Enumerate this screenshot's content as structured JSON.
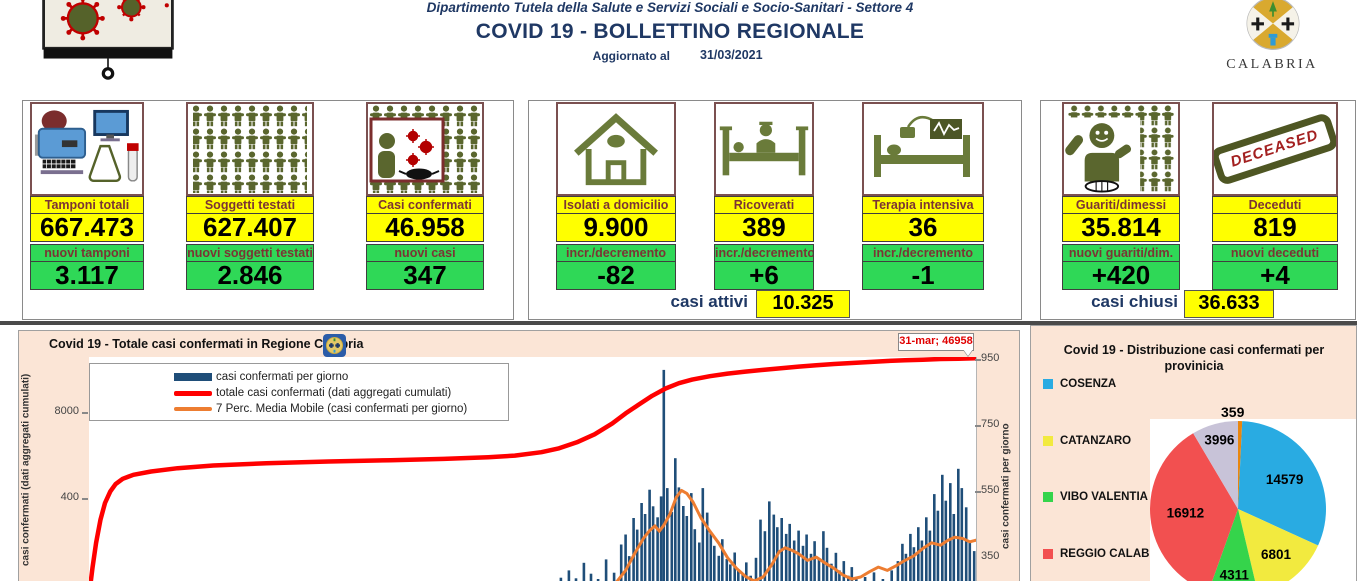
{
  "header": {
    "department": "Dipartimento Tutela della Salute e Servizi Sociali e Socio-Sanitari - Settore 4",
    "title": "COVID 19 - BOLLETTINO REGIONALE",
    "updated_label": "Aggiornato al",
    "updated_date": "31/03/2021",
    "region_name": "CALABRIA"
  },
  "cards": [
    {
      "label": "Tamponi totali",
      "value": "667.473",
      "sub_label": "nuovi tamponi",
      "sub_value": "3.117"
    },
    {
      "label": "Soggetti testati",
      "value": "627.407",
      "sub_label": "nuovi soggetti testati",
      "sub_value": "2.846"
    },
    {
      "label": "Casi confermati",
      "value": "46.958",
      "sub_label": "nuovi casi",
      "sub_value": "347"
    },
    {
      "label": "Isolati a domicilio",
      "value": "9.900",
      "sub_label": "incr./decremento",
      "sub_value": "-82"
    },
    {
      "label": "Ricoverati",
      "value": "389",
      "sub_label": "incr./decremento",
      "sub_value": "+6"
    },
    {
      "label": "Terapia intensiva",
      "value": "36",
      "sub_label": "incr./decremento",
      "sub_value": "-1"
    },
    {
      "label": "Guariti/dimessi",
      "value": "35.814",
      "sub_label": "nuovi guariti/dim.",
      "sub_value": "+420"
    },
    {
      "label": "Deceduti",
      "value": "819",
      "sub_label": "nuovi deceduti",
      "sub_value": "+4",
      "stamp_text": "DECEASED"
    }
  ],
  "summary": {
    "active_label": "casi attivi",
    "active_value": "10.325",
    "closed_label": "casi chiusi",
    "closed_value": "36.633"
  },
  "chart_data": [
    {
      "type": "combo",
      "title": "Covid 19 - Totale casi confermati in Regione Calabria",
      "annotation": "31-mar; 46958",
      "final_cumulative": 46958,
      "colors": {
        "bar": "#1F4E79",
        "cumulative": "#FF0000",
        "ma7": "#ED7D31",
        "background": "#FBE5D6"
      },
      "legend": [
        "casi confermati per giorno",
        "totale casi confermati (dati aggregati cumulati)",
        "7 Perc. Media Mobile (casi confermati per giorno)"
      ],
      "left_axis": {
        "label": "casi confermati (dati aggregati cumulati)",
        "ticks": [
          "8000",
          "400"
        ]
      },
      "right_axis": {
        "label": "casi confermati  per giorno",
        "ticks": [
          950,
          750,
          550,
          350
        ]
      },
      "bars": [
        [
          0.532,
          290
        ],
        [
          0.541,
          312
        ],
        [
          0.549,
          288
        ],
        [
          0.558,
          335
        ],
        [
          0.566,
          302
        ],
        [
          0.574,
          286
        ],
        [
          0.583,
          345
        ],
        [
          0.592,
          305
        ],
        [
          0.6,
          390
        ],
        [
          0.605,
          420
        ],
        [
          0.609,
          355
        ],
        [
          0.614,
          470
        ],
        [
          0.618,
          435
        ],
        [
          0.623,
          515
        ],
        [
          0.627,
          482
        ],
        [
          0.632,
          555
        ],
        [
          0.636,
          505
        ],
        [
          0.641,
          472
        ],
        [
          0.645,
          535
        ],
        [
          0.648,
          916
        ],
        [
          0.652,
          560
        ],
        [
          0.657,
          488
        ],
        [
          0.661,
          650
        ],
        [
          0.665,
          562
        ],
        [
          0.67,
          506
        ],
        [
          0.674,
          476
        ],
        [
          0.679,
          545
        ],
        [
          0.683,
          436
        ],
        [
          0.688,
          396
        ],
        [
          0.692,
          560
        ],
        [
          0.697,
          486
        ],
        [
          0.701,
          426
        ],
        [
          0.705,
          386
        ],
        [
          0.71,
          356
        ],
        [
          0.714,
          406
        ],
        [
          0.719,
          346
        ],
        [
          0.723,
          330
        ],
        [
          0.728,
          366
        ],
        [
          0.732,
          316
        ],
        [
          0.737,
          300
        ],
        [
          0.741,
          336
        ],
        [
          0.746,
          296
        ],
        [
          0.752,
          350
        ],
        [
          0.757,
          465
        ],
        [
          0.762,
          430
        ],
        [
          0.767,
          520
        ],
        [
          0.772,
          480
        ],
        [
          0.776,
          442
        ],
        [
          0.781,
          470
        ],
        [
          0.786,
          422
        ],
        [
          0.79,
          452
        ],
        [
          0.795,
          402
        ],
        [
          0.8,
          432
        ],
        [
          0.805,
          386
        ],
        [
          0.809,
          420
        ],
        [
          0.814,
          362
        ],
        [
          0.818,
          400
        ],
        [
          0.823,
          346
        ],
        [
          0.828,
          430
        ],
        [
          0.832,
          380
        ],
        [
          0.837,
          332
        ],
        [
          0.842,
          365
        ],
        [
          0.846,
          312
        ],
        [
          0.851,
          340
        ],
        [
          0.856,
          296
        ],
        [
          0.86,
          322
        ],
        [
          0.865,
          288
        ],
        [
          0.875,
          292
        ],
        [
          0.885,
          306
        ],
        [
          0.895,
          286
        ],
        [
          0.905,
          312
        ],
        [
          0.912,
          340
        ],
        [
          0.917,
          392
        ],
        [
          0.921,
          362
        ],
        [
          0.926,
          422
        ],
        [
          0.93,
          382
        ],
        [
          0.935,
          442
        ],
        [
          0.939,
          402
        ],
        [
          0.944,
          472
        ],
        [
          0.948,
          432
        ],
        [
          0.953,
          542
        ],
        [
          0.957,
          492
        ],
        [
          0.962,
          600
        ],
        [
          0.966,
          522
        ],
        [
          0.971,
          575
        ],
        [
          0.975,
          482
        ],
        [
          0.98,
          618
        ],
        [
          0.984,
          560
        ],
        [
          0.989,
          502
        ],
        [
          0.993,
          402
        ],
        [
          0.998,
          370
        ]
      ],
      "cumulative": [
        [
          0,
          235
        ],
        [
          0.004,
          320
        ],
        [
          0.008,
          395
        ],
        [
          0.013,
          465
        ],
        [
          0.018,
          515
        ],
        [
          0.024,
          550
        ],
        [
          0.03,
          572
        ],
        [
          0.038,
          588
        ],
        [
          0.05,
          600
        ],
        [
          0.07,
          610
        ],
        [
          0.1,
          620
        ],
        [
          0.14,
          628
        ],
        [
          0.2,
          635
        ],
        [
          0.27,
          640
        ],
        [
          0.34,
          644
        ],
        [
          0.4,
          648
        ],
        [
          0.45,
          653
        ],
        [
          0.48,
          658
        ],
        [
          0.51,
          668
        ],
        [
          0.53,
          680
        ],
        [
          0.55,
          698
        ],
        [
          0.57,
          722
        ],
        [
          0.59,
          755
        ],
        [
          0.605,
          785
        ],
        [
          0.62,
          812
        ],
        [
          0.635,
          838
        ],
        [
          0.65,
          860
        ],
        [
          0.665,
          876
        ],
        [
          0.68,
          887
        ],
        [
          0.7,
          897
        ],
        [
          0.72,
          905
        ],
        [
          0.74,
          911
        ],
        [
          0.76,
          916
        ],
        [
          0.78,
          921
        ],
        [
          0.8,
          926
        ],
        [
          0.82,
          930
        ],
        [
          0.84,
          934
        ],
        [
          0.86,
          937
        ],
        [
          0.88,
          940
        ],
        [
          0.9,
          943
        ],
        [
          0.92,
          945
        ],
        [
          0.94,
          947
        ],
        [
          0.96,
          949
        ],
        [
          0.98,
          950
        ],
        [
          1.0,
          951
        ]
      ],
      "ma7": [
        [
          0.595,
          278
        ],
        [
          0.605,
          312
        ],
        [
          0.615,
          362
        ],
        [
          0.625,
          408
        ],
        [
          0.632,
          432
        ],
        [
          0.638,
          446
        ],
        [
          0.643,
          430
        ],
        [
          0.648,
          448
        ],
        [
          0.655,
          482
        ],
        [
          0.662,
          532
        ],
        [
          0.668,
          553
        ],
        [
          0.674,
          544
        ],
        [
          0.681,
          518
        ],
        [
          0.69,
          470
        ],
        [
          0.7,
          430
        ],
        [
          0.71,
          394
        ],
        [
          0.72,
          350
        ],
        [
          0.73,
          318
        ],
        [
          0.74,
          294
        ],
        [
          0.75,
          280
        ],
        [
          0.76,
          292
        ],
        [
          0.77,
          330
        ],
        [
          0.778,
          368
        ],
        [
          0.785,
          380
        ],
        [
          0.793,
          372
        ],
        [
          0.8,
          362
        ],
        [
          0.81,
          342
        ],
        [
          0.82,
          352
        ],
        [
          0.83,
          334
        ],
        [
          0.84,
          318
        ],
        [
          0.85,
          298
        ],
        [
          0.86,
          286
        ],
        [
          0.87,
          292
        ],
        [
          0.88,
          308
        ],
        [
          0.89,
          322
        ],
        [
          0.9,
          312
        ],
        [
          0.91,
          326
        ],
        [
          0.92,
          342
        ],
        [
          0.93,
          356
        ],
        [
          0.94,
          378
        ],
        [
          0.95,
          395
        ],
        [
          0.96,
          388
        ],
        [
          0.968,
          402
        ],
        [
          0.976,
          412
        ],
        [
          0.985,
          408
        ],
        [
          0.993,
          398
        ],
        [
          1.0,
          403
        ]
      ]
    },
    {
      "type": "pie",
      "title": "Covid 19 - Distribuzione casi confermati per provinicia",
      "total": 46958,
      "legend": [
        {
          "label": "COSENZA",
          "color": "#29ABE2"
        },
        {
          "label": "CATANZARO",
          "color": "#F2EA3F"
        },
        {
          "label": "VIBO VALENTIA",
          "color": "#35D44B"
        },
        {
          "label": "REGGIO CALABRIA",
          "color": "#F25050"
        }
      ],
      "slices": [
        {
          "value": 359,
          "label": "359",
          "color": "#E8860F"
        },
        {
          "value": 14579,
          "label": "14579",
          "color": "#29ABE2",
          "legend": "COSENZA"
        },
        {
          "value": 6801,
          "label": "6801",
          "color": "#F2EA3F",
          "legend": "CATANZARO"
        },
        {
          "value": 4311,
          "label": "4311",
          "color": "#35D44B",
          "legend": "VIBO VALENTIA"
        },
        {
          "value": 16912,
          "label": "16912",
          "color": "#F25050",
          "legend": "REGGIO CALABRIA"
        },
        {
          "value": 3996,
          "label": "3996",
          "color": "#C8C3D8"
        }
      ]
    }
  ]
}
